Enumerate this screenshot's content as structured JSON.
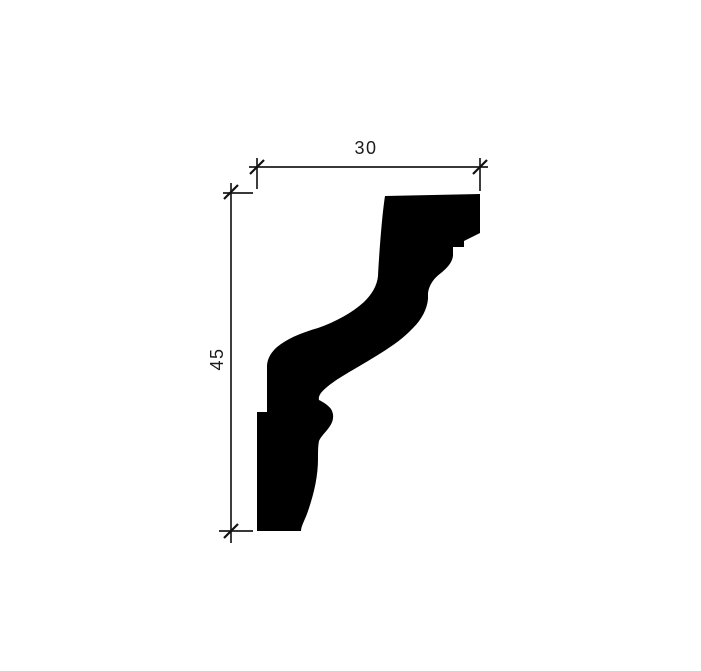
{
  "figure": {
    "kind": "molding-profile-cross-section",
    "ink_color": "#000000",
    "background_color": "#ffffff",
    "dimensions": {
      "width": {
        "value": "30",
        "orientation": "horizontal"
      },
      "height": {
        "value": "45",
        "orientation": "vertical"
      }
    },
    "profile_path": "M 385 196 L 480 194 L 480 233 L 464 241 L 464 247 L 453 247 L 453 256 C 452 263 447 268 441 273 C 434 278 429 285 428 293 L 428 299 C 427 309 422 319 413 328 C 401 341 386 350 368 361 C 351 371 335 380 327 387 C 321 392 318 396 319 400 C 323 402 328 405 331 409 C 334 414 334 420 330 426 C 327 431 321 436 319 441 C 318 446 318 452 318 459 C 318 476 314 494 308 511 C 305 520 301 526 301 531 L 257 531 L 257 412 L 267 412 L 267 367 C 267 359 271 351 281 344 C 291 337 304 332 318 328 C 335 322 352 313 364 302 C 372 294 377 286 378 276 C 379 255 382 215 385 196 Z"
  }
}
